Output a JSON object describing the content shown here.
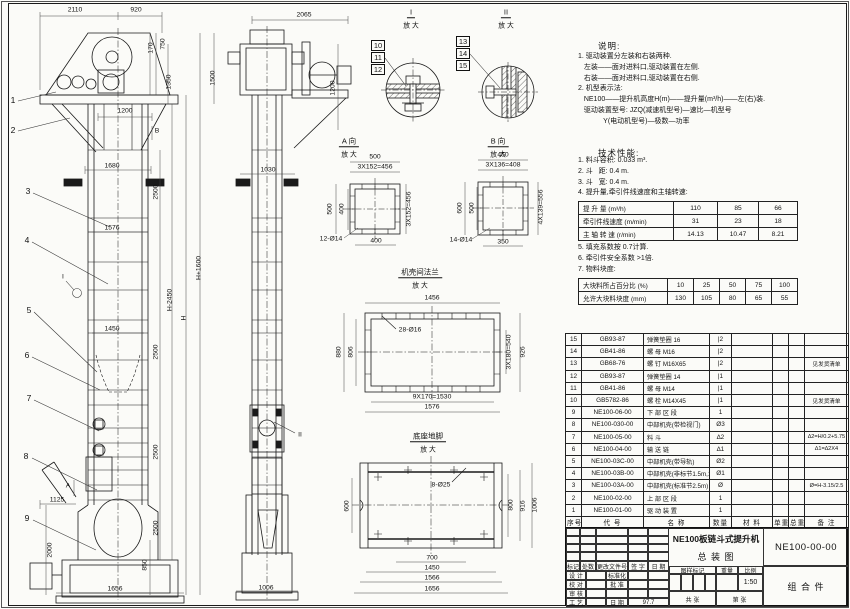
{
  "sheet": {
    "bg": "#fbfbf8",
    "line_color": "#1a1a1a"
  },
  "notes": {
    "heading": "说明:",
    "lines": [
      "1. 驱动装置分左装和右装两种.",
      "   左装——面对进料口,驱动装置在左侧.",
      "   右装——面对进料口,驱动装置在右侧.",
      "2. 机型表示法:",
      "   NE100——提升机高度H(m)——提升量(m³/h)——左(右)装.",
      "   驱动装置型号: JZQ(减速机型号)—速比—机型号",
      "             Y(电动机型号)—极数—功率"
    ]
  },
  "tech": {
    "heading": "技术性能:",
    "items_before": [
      "1. 料斗容积: 0.033 m³.",
      "2. 斗   距: 0.4 m.",
      "3. 斗   宽: 0.4 m.",
      "4. 提升量,牵引件线速度和主轴转速:"
    ],
    "items_after": [
      "5. 填充系数按 0.7计算.",
      "6. 牵引件安全系数 >1倍.",
      "7. 物料块度:"
    ],
    "table1": {
      "rows": [
        {
          "label": "提 升 量  (m³/h)",
          "c1": "110",
          "c2": "85",
          "c3": "66"
        },
        {
          "label": "牵引件线速度 (m/min)",
          "c1": "31",
          "c2": "23",
          "c3": "18"
        },
        {
          "label": "主 轴 转 速 (r/min)",
          "c1": "14.13",
          "c2": "10.47",
          "c3": "8.21"
        }
      ]
    },
    "table2": {
      "rows": [
        {
          "label": "大块料所占百分比 (%)",
          "c1": "10",
          "c2": "25",
          "c3": "50",
          "c4": "75",
          "c5": "100"
        },
        {
          "label": "允许大块料块度 (mm)",
          "c1": "130",
          "c2": "105",
          "c3": "80",
          "c4": "65",
          "c5": "55"
        }
      ]
    }
  },
  "bom": {
    "headers": {
      "no": "序号",
      "code": "代  号",
      "name": "名  称",
      "qty": "数量",
      "material": "材  料",
      "unit": "单重",
      "total": "总重",
      "remark": "备 注"
    },
    "rows": [
      {
        "no": "15",
        "code": "GB93-87",
        "name": "弹簧垫圈  16",
        "qty": "|2",
        "material": "",
        "unit": "",
        "total": "",
        "remark": ""
      },
      {
        "no": "14",
        "code": "GB41-86",
        "name": "螺  母  M16",
        "qty": "|2",
        "material": "",
        "unit": "",
        "total": "",
        "remark": ""
      },
      {
        "no": "13",
        "code": "GB68-76",
        "name": "螺  钉  M16X65",
        "qty": "|2",
        "material": "",
        "unit": "",
        "total": "",
        "remark": "见发货清单"
      },
      {
        "no": "12",
        "code": "GB93-87",
        "name": "弹簧垫圈  14",
        "qty": "|1",
        "material": "",
        "unit": "",
        "total": "",
        "remark": ""
      },
      {
        "no": "11",
        "code": "GB41-86",
        "name": "螺  母  M14",
        "qty": "|1",
        "material": "",
        "unit": "",
        "total": "",
        "remark": ""
      },
      {
        "no": "10",
        "code": "GB5782-86",
        "name": "螺  栓  M14X45",
        "qty": "|1",
        "material": "",
        "unit": "",
        "total": "",
        "remark": "见发货清单"
      },
      {
        "no": "9",
        "code": "NE100-06-00",
        "name": "下 部 区 段",
        "qty": "1",
        "material": "",
        "unit": "",
        "total": "",
        "remark": ""
      },
      {
        "no": "8",
        "code": "NE100-030-00",
        "name": "中部机壳(带检视门)",
        "qty": "Ø3",
        "material": "",
        "unit": "",
        "total": "",
        "remark": ""
      },
      {
        "no": "7",
        "code": "NE100-05-00",
        "name": "料  斗",
        "qty": "∆2",
        "material": "",
        "unit": "",
        "total": "",
        "remark": "∆2=H/0.2+5.75"
      },
      {
        "no": "6",
        "code": "NE100-04-00",
        "name": "输 送 链",
        "qty": "∆1",
        "material": "",
        "unit": "",
        "total": "",
        "remark": "∆1=∆2X4"
      },
      {
        "no": "5",
        "code": "NE100-03C-00",
        "name": "中部机壳(带导轨)",
        "qty": "Ø2",
        "material": "",
        "unit": "",
        "total": "",
        "remark": ""
      },
      {
        "no": "4",
        "code": "NE100-03B-00",
        "name": "中部机壳(非标节1.5m,1m)",
        "qty": "Ø1",
        "material": "",
        "unit": "",
        "total": "",
        "remark": ""
      },
      {
        "no": "3",
        "code": "NE100-03A-00",
        "name": "中部机壳(标准节2.5m)",
        "qty": "Ø",
        "material": "",
        "unit": "",
        "total": "",
        "remark": "Ø=H-3.15/2.5"
      },
      {
        "no": "2",
        "code": "NE100-02-00",
        "name": "上 部 区 段",
        "qty": "1",
        "material": "",
        "unit": "",
        "total": "",
        "remark": ""
      },
      {
        "no": "1",
        "code": "NE100-01-00",
        "name": "驱 动 装 置",
        "qty": "1",
        "material": "",
        "unit": "",
        "total": "",
        "remark": ""
      }
    ]
  },
  "title_block": {
    "product": "NE100板链斗式提升机",
    "drawing": "总  装  图",
    "number": "NE100-00-00",
    "part_type": "组 合 件",
    "scale": "1:50",
    "date": "97.7",
    "labels": {
      "mark": "标记",
      "count": "处数",
      "doc": "更改文件号",
      "sign": "签 字",
      "date_h": "日 期",
      "design": "设 计",
      "std": "标准化",
      "check": "校 对",
      "approve": "批 准",
      "audit": "审 核",
      "craft": "工 艺",
      "date2": "日 期",
      "stamp": "图样标记",
      "weight": "重量",
      "ratio": "比例",
      "sheets": "共    张",
      "page": "第    张"
    }
  },
  "annotations": {
    "labels": [
      {
        "t": "2110",
        "x": 75,
        "y": 11
      },
      {
        "t": "920",
        "x": 136,
        "y": 11
      },
      {
        "t": "170",
        "x": 152,
        "y": 48,
        "r": 1
      },
      {
        "t": "750",
        "x": 164,
        "y": 44,
        "r": 1
      },
      {
        "t": "1350",
        "x": 170,
        "y": 82,
        "r": 1
      },
      {
        "t": "1500",
        "x": 214,
        "y": 78,
        "r": 1
      },
      {
        "t": "1200",
        "x": 125,
        "y": 112
      },
      {
        "t": "B",
        "x": 157,
        "y": 132
      },
      {
        "t": "1680",
        "x": 112,
        "y": 167
      },
      {
        "t": "2500",
        "x": 157,
        "y": 192,
        "r": 1
      },
      {
        "t": "1576",
        "x": 112,
        "y": 229
      },
      {
        "t": "H+1600",
        "x": 200,
        "y": 268,
        "r": 1
      },
      {
        "t": "H-2450",
        "x": 171,
        "y": 300,
        "r": 1
      },
      {
        "t": "H",
        "x": 185,
        "y": 318,
        "r": 1
      },
      {
        "t": "1450",
        "x": 112,
        "y": 330
      },
      {
        "t": "2500",
        "x": 157,
        "y": 352,
        "r": 1
      },
      {
        "t": "2500",
        "x": 157,
        "y": 452,
        "r": 1
      },
      {
        "t": "2500",
        "x": 157,
        "y": 528,
        "r": 1
      },
      {
        "t": "850",
        "x": 146,
        "y": 565,
        "r": 1
      },
      {
        "t": "1125",
        "x": 57,
        "y": 501
      },
      {
        "t": "2000",
        "x": 51,
        "y": 550,
        "r": 1
      },
      {
        "t": "1656",
        "x": 115,
        "y": 590
      },
      {
        "t": "A",
        "x": 68,
        "y": 487
      },
      {
        "t": "I",
        "x": 63,
        "y": 278
      },
      {
        "t": "2065",
        "x": 304,
        "y": 16
      },
      {
        "t": "1200",
        "x": 334,
        "y": 88,
        "r": 1
      },
      {
        "t": "1030",
        "x": 268,
        "y": 171
      },
      {
        "t": "1006",
        "x": 266,
        "y": 589
      },
      {
        "t": "II",
        "x": 300,
        "y": 436
      },
      {
        "t": "I",
        "x": 411,
        "y": 13,
        "cls": "vh"
      },
      {
        "t": "放 大",
        "x": 411,
        "y": 27
      },
      {
        "t": "II",
        "x": 506,
        "y": 13,
        "cls": "vh"
      },
      {
        "t": "放 大",
        "x": 506,
        "y": 27
      },
      {
        "t": "A 向",
        "x": 349,
        "y": 142,
        "cls": "vh"
      },
      {
        "t": "放 大",
        "x": 349,
        "y": 156
      },
      {
        "t": "B 向",
        "x": 498,
        "y": 142,
        "cls": "vh"
      },
      {
        "t": "放 大",
        "x": 498,
        "y": 156
      },
      {
        "t": "500",
        "x": 375,
        "y": 158
      },
      {
        "t": "3X152=456",
        "x": 375,
        "y": 168
      },
      {
        "t": "500",
        "x": 331,
        "y": 209,
        "r": 1
      },
      {
        "t": "400",
        "x": 343,
        "y": 209,
        "r": 1
      },
      {
        "t": "400",
        "x": 376,
        "y": 242
      },
      {
        "t": "3X152=456",
        "x": 410,
        "y": 209,
        "r": 1
      },
      {
        "t": "12-Ø14",
        "x": 331,
        "y": 240
      },
      {
        "t": "450",
        "x": 503,
        "y": 156
      },
      {
        "t": "3X136=408",
        "x": 503,
        "y": 166
      },
      {
        "t": "600",
        "x": 461,
        "y": 208,
        "r": 1
      },
      {
        "t": "500",
        "x": 473,
        "y": 208,
        "r": 1
      },
      {
        "t": "350",
        "x": 503,
        "y": 243
      },
      {
        "t": "4X139=556",
        "x": 542,
        "y": 207,
        "r": 1
      },
      {
        "t": "14-Ø14",
        "x": 461,
        "y": 241
      },
      {
        "t": "机壳间法兰",
        "x": 420,
        "y": 273,
        "cls": "vh"
      },
      {
        "t": "放 大",
        "x": 420,
        "y": 287
      },
      {
        "t": "1456",
        "x": 432,
        "y": 299
      },
      {
        "t": "880",
        "x": 340,
        "y": 352,
        "r": 1
      },
      {
        "t": "806",
        "x": 352,
        "y": 352,
        "r": 1
      },
      {
        "t": "28-Ø16",
        "x": 410,
        "y": 331
      },
      {
        "t": "3X180=540",
        "x": 510,
        "y": 352,
        "r": 1
      },
      {
        "t": "926",
        "x": 524,
        "y": 352,
        "r": 1
      },
      {
        "t": "9X170=1530",
        "x": 432,
        "y": 398
      },
      {
        "t": "1576",
        "x": 432,
        "y": 408
      },
      {
        "t": "底座地脚",
        "x": 428,
        "y": 437,
        "cls": "vh"
      },
      {
        "t": "放 大",
        "x": 428,
        "y": 451
      },
      {
        "t": "8-Ø25",
        "x": 441,
        "y": 486
      },
      {
        "t": "600",
        "x": 348,
        "y": 506,
        "r": 1
      },
      {
        "t": "800",
        "x": 512,
        "y": 505,
        "r": 1
      },
      {
        "t": "916",
        "x": 524,
        "y": 506,
        "r": 1
      },
      {
        "t": "1006",
        "x": 536,
        "y": 505,
        "r": 1
      },
      {
        "t": "700",
        "x": 432,
        "y": 559
      },
      {
        "t": "1450",
        "x": 432,
        "y": 569
      },
      {
        "t": "1566",
        "x": 432,
        "y": 579
      },
      {
        "t": "1656",
        "x": 432,
        "y": 590
      }
    ],
    "balloons": [
      {
        "n": "1",
        "x": 13,
        "y": 100
      },
      {
        "n": "2",
        "x": 13,
        "y": 130
      },
      {
        "n": "3",
        "x": 28,
        "y": 191
      },
      {
        "n": "4",
        "x": 27,
        "y": 240
      },
      {
        "n": "5",
        "x": 29,
        "y": 310
      },
      {
        "n": "6",
        "x": 27,
        "y": 355
      },
      {
        "n": "7",
        "x": 29,
        "y": 398
      },
      {
        "n": "8",
        "x": 26,
        "y": 456
      },
      {
        "n": "9",
        "x": 27,
        "y": 518
      }
    ],
    "callouts": [
      {
        "n": "10",
        "x": 371,
        "y": 40
      },
      {
        "n": "11",
        "x": 371,
        "y": 52
      },
      {
        "n": "12",
        "x": 371,
        "y": 64
      },
      {
        "n": "13",
        "x": 456,
        "y": 36
      },
      {
        "n": "14",
        "x": 456,
        "y": 48
      },
      {
        "n": "15",
        "x": 456,
        "y": 60
      }
    ]
  }
}
